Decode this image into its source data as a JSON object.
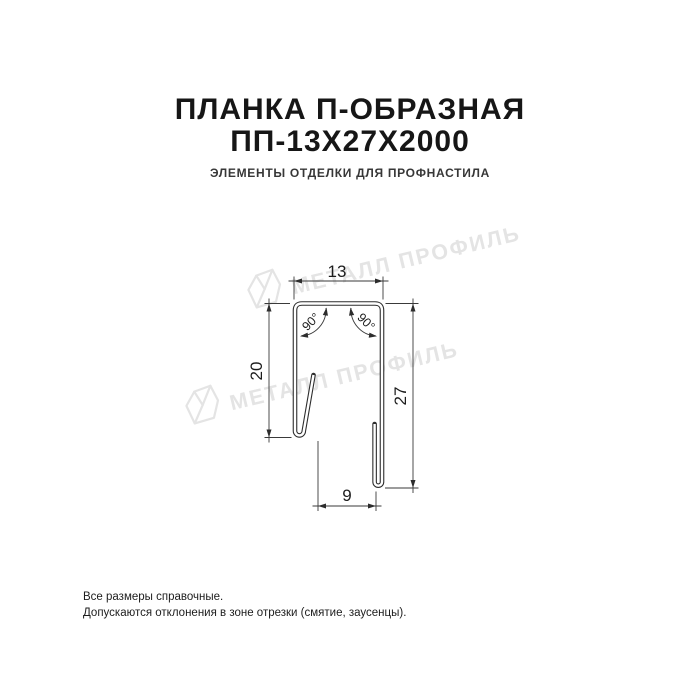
{
  "card": {
    "background_color": "#ffffff",
    "title_line1": "ПЛАНКА П-ОБРАЗНАЯ",
    "title_line2": "ПП-13Х27Х2000",
    "title_color": "#161616",
    "subtitle": "ЭЛЕМЕНТЫ ОТДЕЛКИ ДЛЯ ПРОФНАСТИЛА",
    "subtitle_color": "#373737"
  },
  "drawing": {
    "description": "Dimensioned cross-section of U-shaped profile strip",
    "line_color": "#2d2d2d",
    "dimension_color": "#1c1c1c",
    "labels": {
      "top_width": "13",
      "left_height": "20",
      "right_height": "27",
      "bottom_width": "9",
      "left_angle": "90°",
      "right_angle": "90°"
    }
  },
  "watermark": {
    "color": "#e4e4e4",
    "items": [
      {
        "text": "МЕТАЛЛ ПРОФИЛЬ"
      },
      {
        "text": "МЕТАЛЛ ПРОФИЛЬ"
      }
    ]
  },
  "footer": {
    "color": "#1d1d1d",
    "line1": "Все размеры справочные.",
    "line2": "Допускаются отклонения в зоне отрезки (смятие, заусенцы)."
  }
}
